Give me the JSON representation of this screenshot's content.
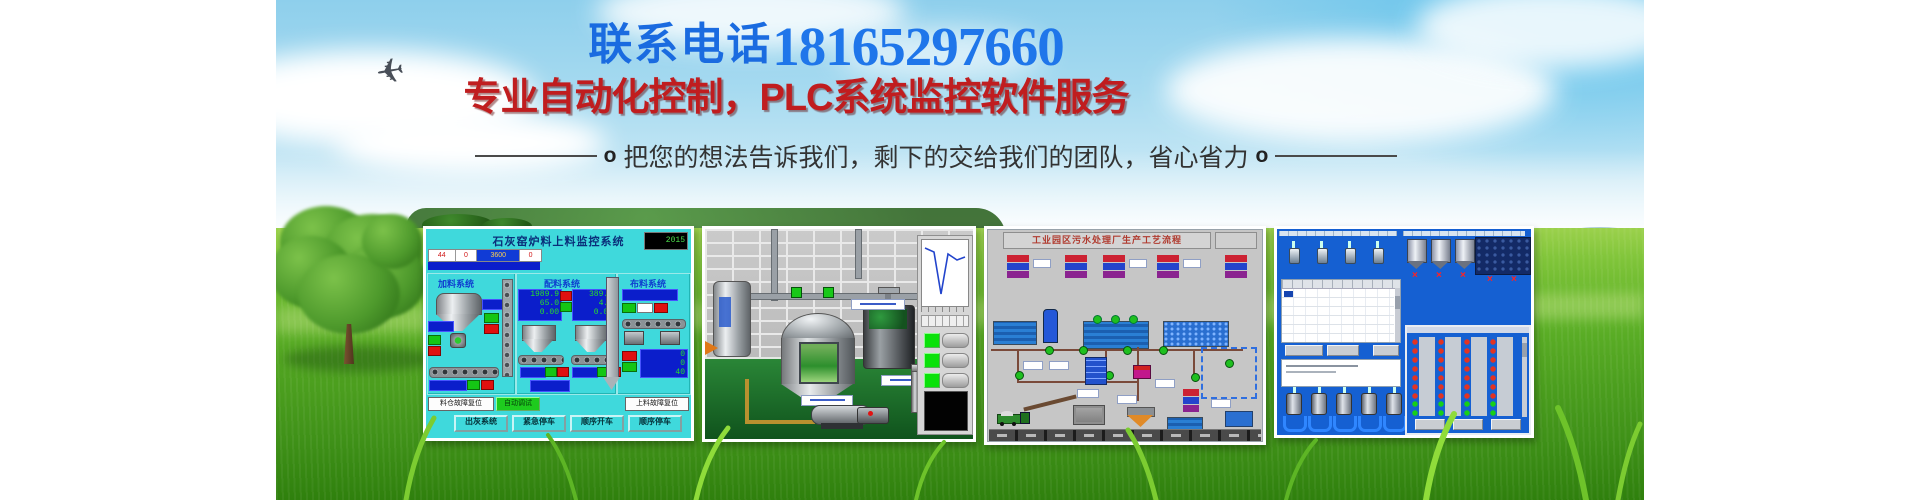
{
  "page": {
    "background": "#ffffff"
  },
  "banner": {
    "phone_label": "联系电话",
    "phone_number": "18165297660",
    "headline": "专业自动化控制，PLC系统监控软件服务",
    "tagline_left_mark": "o",
    "tagline": "把您的想法告诉我们，剩下的交给我们的团队，省心省力",
    "tagline_right_mark": "o",
    "colors": {
      "phone_blue": "#1a6be0",
      "headline_red": "#c01d1f",
      "tagline_gray": "#333333",
      "sky_blue": "#8ecfec",
      "grass_green": "#4da01f",
      "hmi_cyan": "#3fd9dc",
      "hmi_blue_desktop": "#1560d2"
    }
  },
  "screens": {
    "lime_kiln": {
      "title": "石灰窑炉料上料监控系统",
      "clock": "2015",
      "strip_values": [
        "44",
        "0",
        "3600",
        "0"
      ],
      "section_feed": "加料系统",
      "section_batch": "配料系统",
      "section_dist": "布料系统",
      "panel1": [
        "1989.9",
        "65.0",
        "0.00"
      ],
      "panel2": [
        "389.9",
        "4.2",
        "0.00"
      ],
      "panel3": [
        "0",
        "0",
        "40"
      ],
      "btn_silo_reset": "料仓故障复位",
      "btn_auto_debug": "自动调试",
      "btn_feed_reset": "上料故障复位",
      "btn_ash": "出灰系统",
      "btn_estop": "紧急停车",
      "btn_seq_start": "顺序开车",
      "btn_seq_stop": "顺序停车"
    },
    "sewage": {
      "title": "工业园区污水处理厂生产工艺流程"
    },
    "batching": {
      "valve_cross": "×"
    }
  }
}
